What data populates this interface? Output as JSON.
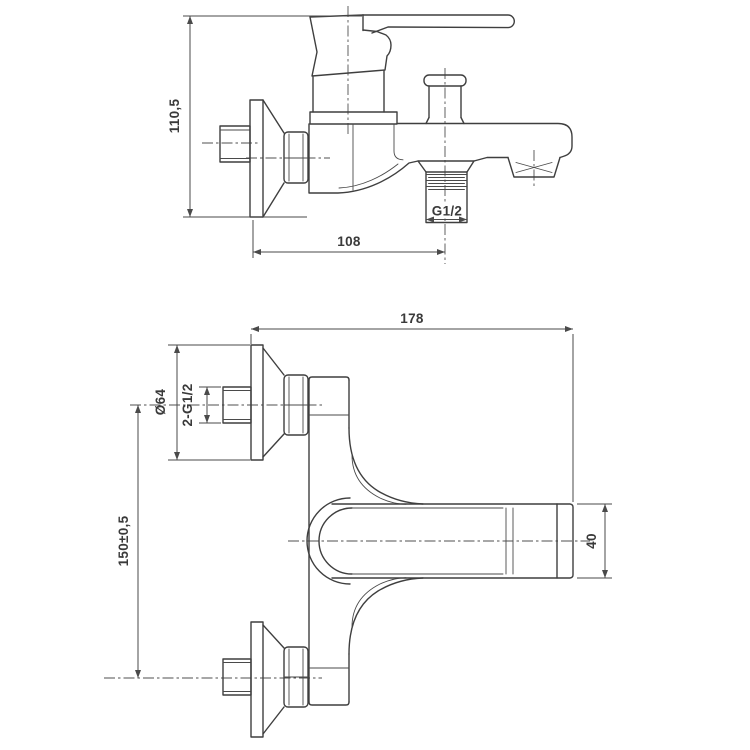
{
  "drawing": {
    "title": "bath-shower-mixer-technical-drawing",
    "side_view": {
      "dim_height": "110,5",
      "dim_spout_reach": "108",
      "thread_label": "G1/2"
    },
    "front_view": {
      "dim_overall_length": "178",
      "dim_flange_diameter": "Ø64",
      "dim_connection_thread": "2-G1/2",
      "dim_connection_spacing": "150±0,5",
      "dim_spout_height": "40"
    },
    "colors": {
      "line": "#3f3f3f",
      "dim_line": "#4a4a4a",
      "text": "#3a3a3a",
      "background": "#ffffff"
    }
  }
}
